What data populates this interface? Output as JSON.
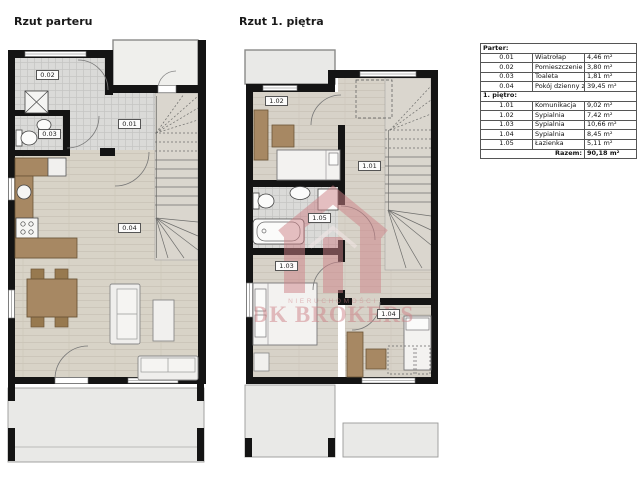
{
  "plans": {
    "ground": {
      "title": "Rzut parteru",
      "rooms": [
        {
          "code": "0.01"
        },
        {
          "code": "0.02"
        },
        {
          "code": "0.03"
        },
        {
          "code": "0.04"
        }
      ]
    },
    "upper": {
      "title": "Rzut 1. piętra",
      "rooms": [
        {
          "code": "1.01"
        },
        {
          "code": "1.02"
        },
        {
          "code": "1.03"
        },
        {
          "code": "1.04"
        },
        {
          "code": "1.05"
        }
      ]
    }
  },
  "area_table": {
    "section1_header": "Parter:",
    "rows_parter": [
      {
        "no": "0.01",
        "name": "Wiatrołap",
        "area": "4,46 m²"
      },
      {
        "no": "0.02",
        "name": "Pomieszczenie gospodarcze",
        "area": "3,80 m²"
      },
      {
        "no": "0.03",
        "name": "Toaleta",
        "area": "1,81 m²"
      },
      {
        "no": "0.04",
        "name": "Pokój dzienny z aneksem",
        "area": "39,45 m²"
      }
    ],
    "section2_header": "1. piętro:",
    "rows_pietro": [
      {
        "no": "1.01",
        "name": "Komunikacja",
        "area": "9,02 m²"
      },
      {
        "no": "1.02",
        "name": "Sypialnia",
        "area": "7,42 m²"
      },
      {
        "no": "1.03",
        "name": "Sypialnia",
        "area": "10,66 m²"
      },
      {
        "no": "1.04",
        "name": "Sypialnia",
        "area": "8,45 m²"
      },
      {
        "no": "1.05",
        "name": "Łazienka",
        "area": "5,11 m²"
      }
    ],
    "total_label": "Razem:",
    "total_value": "90,18 m²"
  },
  "watermark": {
    "small_text": "NIERUCHOMOŚCI",
    "brand": "DK BROKERS",
    "color": "#cf8288"
  },
  "colors": {
    "wall": "#141414",
    "wood_floor": "#d8d3c7",
    "tile_floor": "#dadad8",
    "furniture_brown": "#a78863",
    "outside_gray": "#e9e9e7",
    "watermark": "#cf8288"
  }
}
